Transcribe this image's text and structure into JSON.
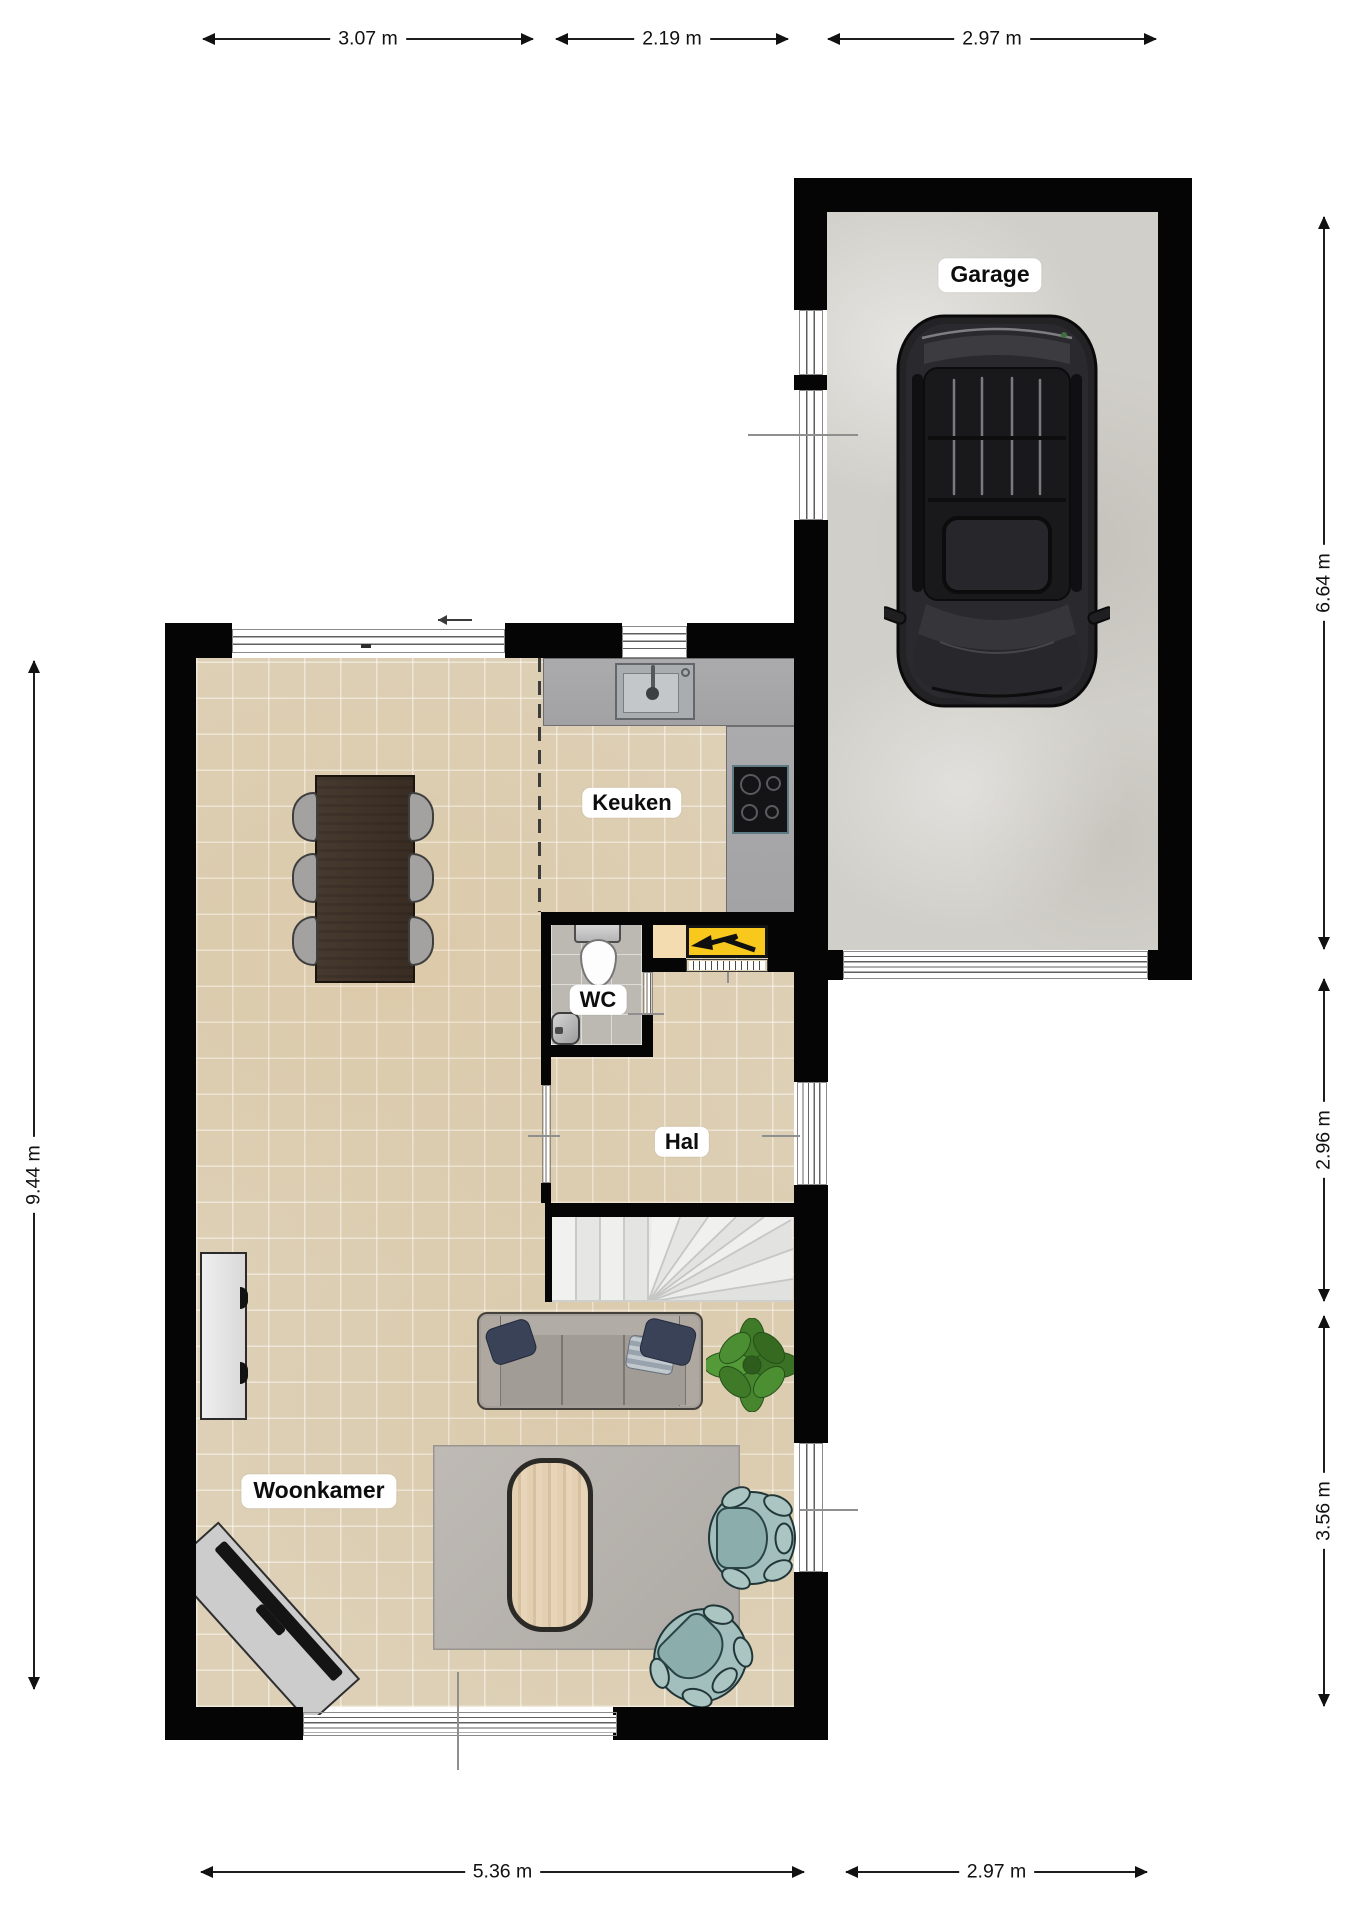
{
  "floorplan": {
    "rooms": {
      "garage": "Garage",
      "keuken": "Keuken",
      "wc": "WC",
      "hal": "Hal",
      "woonkamer": "Woonkamer"
    },
    "dimensions": {
      "top": [
        "3.07 m",
        "2.19 m",
        "2.97 m"
      ],
      "bottom": [
        "5.36 m",
        "2.97 m"
      ],
      "left": [
        "9.44 m"
      ],
      "right": [
        "6.64 m",
        "2.96 m",
        "3.56 m"
      ]
    },
    "icons": {
      "electric_meter": "lightning-arrow-icon",
      "entry_arrow": "left-arrow-icon"
    },
    "colors": {
      "wall": "#050505",
      "floor_tiles": "#ddd0b6",
      "garage_floor": "#d1cfc9",
      "wc_floor": "#bcb8b2",
      "kitchen_counter": "#a6a6a8",
      "meter_box_yellow": "#f8c81c",
      "sofa_grey": "#a59f99",
      "armchair_teal": "#a3bfbd",
      "table_wood": "#40332a",
      "plant_green": "#47862f",
      "car_black": "#232326"
    }
  }
}
